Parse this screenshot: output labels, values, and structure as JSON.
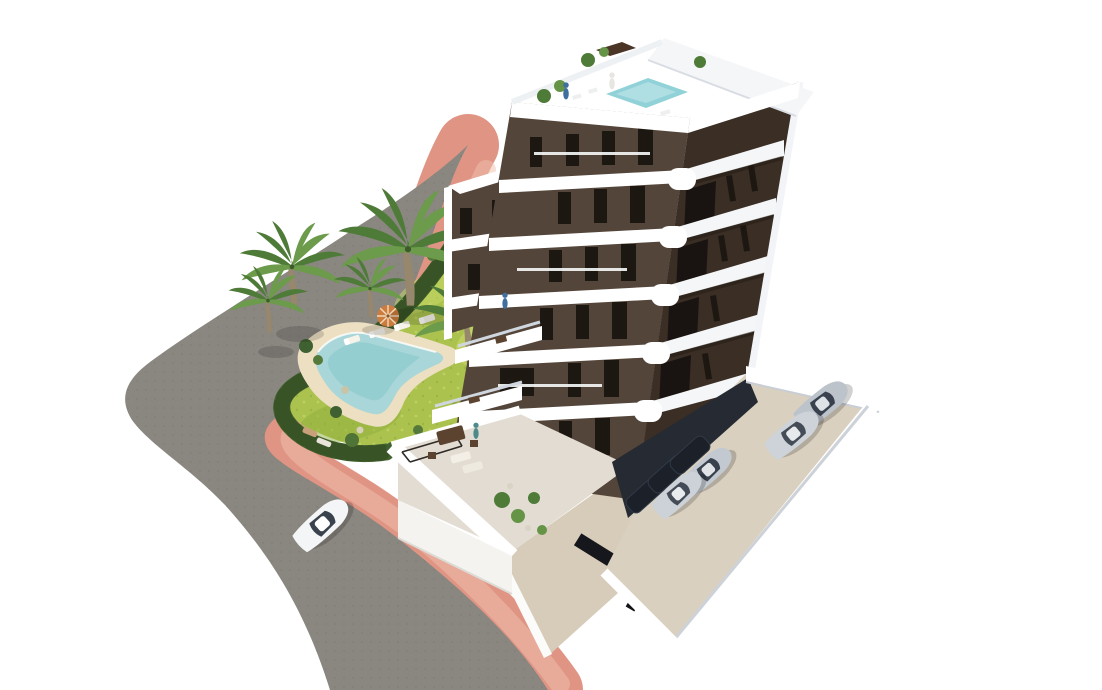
{
  "image": {
    "type": "3d-architectural-render",
    "subject": "aerial view of a modern white-and-brown apartment tower with rooftop pool, landscaped garden with free-form swimming pool, palm trees, curved road with pink sidewalk, and parking areas with cars",
    "width": 1102,
    "height": 690
  },
  "palette": {
    "bg": "#ffffff",
    "road": "#8a8680",
    "road_dark": "#767269",
    "sidewalk": "#e09584",
    "sidewalk_light": "#f0bfae",
    "hedge": "#44622f",
    "hedge_dark": "#2f481f",
    "lawn": "#abc24f",
    "lawn_light": "#c9d96a",
    "lawn_dark": "#8fae3c",
    "deck": "#ecdfc2",
    "pool": "#a9d6d8",
    "pool_deep": "#8ccacd",
    "facade": "#54453a",
    "facade_dark": "#3a2e25",
    "window": "#1d1712",
    "slab": "#f4f6f8",
    "slab_shadow": "#ccd3dc",
    "roof_pool": "#90d2d8",
    "terrace_floor": "#e2dcd2",
    "parking_floor": "#d9d0bf",
    "drive": "#d6ccb9",
    "car_white": "#f4f5f6",
    "car_silver": "#bcc3cb",
    "car_silver2": "#cdd3d8",
    "car_dark": "#232a36",
    "car_glass": "#39414e",
    "umbrella": "#cb7c3e",
    "furniture": "#5b4330",
    "palm_frond": "#4e7b38",
    "palm_frond_light": "#6b9b4b",
    "palm_trunk": "#97876c"
  },
  "scene": {
    "building": {
      "floors_visible": 7,
      "facade": "dark brown panels",
      "balconies": "white wrap-around bands with rounded corners",
      "rooftop": [
        "small plunge pool",
        "terrace with plants",
        "people standing"
      ],
      "ground_level": [
        "large private terrace with outdoor furniture",
        "stepped lower terraces"
      ]
    },
    "garden": {
      "pool_shape": "free-form boomerang",
      "sun_loungers": 6,
      "parasols": 2,
      "palm_trees": 5,
      "hedge": "curved dark-green perimeter hedge",
      "sunbathers": 2
    },
    "road": {
      "surface": "grey asphalt, curved corner",
      "sidewalk": "pink pavement band following the road"
    },
    "vehicles": {
      "driving_on_road": 1,
      "parked_in_lot": 4,
      "parked_under_building": 3
    }
  }
}
